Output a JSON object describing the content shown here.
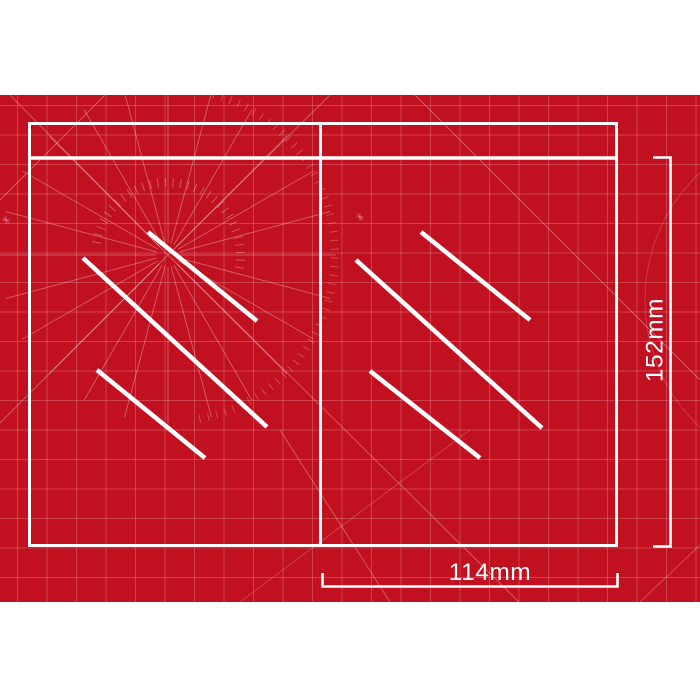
{
  "dimensions": {
    "height_label": "152mm",
    "width_label": "114mm"
  },
  "colors": {
    "mat_red": "#C1101F",
    "grid_line": "#CE4A52",
    "marking_white": "#FFFFFF"
  }
}
